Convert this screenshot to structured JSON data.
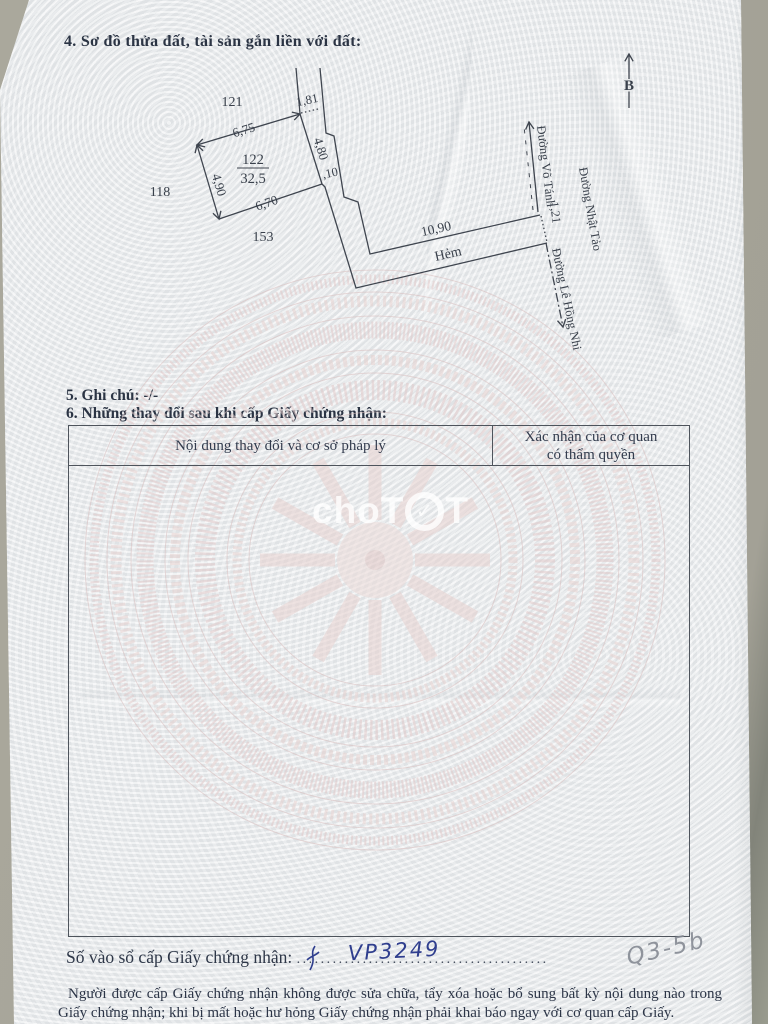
{
  "document": {
    "section4_heading": "4. Sơ đồ thửa đất, tài sản gắn liền với đất:",
    "section5_heading": "5. Ghi chú: -/-",
    "section6_heading": "6. Những thay đổi sau khi cấp Giấy chứng nhận:"
  },
  "diagram": {
    "north_label": "B",
    "parcel_number": "122",
    "parcel_area": "32,5",
    "adjacent_parcels": {
      "top": "121",
      "left": "118",
      "bottom": "153"
    },
    "dimensions": {
      "top_edge": "6,75",
      "left_edge": "4,90",
      "bottom_edge": "6,70",
      "right_edge": "4,80",
      "alley_top_width": "1,81",
      "step": ",10",
      "alley_length": "10,90",
      "street_frontage": "1,21"
    },
    "roads": {
      "alley": "Hẻm",
      "street_vo_tanh": "Đường Võ Tánh",
      "street_nhat_tao": "Đường Nhật Tảo",
      "street_le_hong_nhi": "Đường Lê Hồng Nhi"
    }
  },
  "table": {
    "col_content_header": "Nội dung thay đổi và cơ sở pháp lý",
    "col_confirm_header_line1": "Xác nhận của cơ quan",
    "col_confirm_header_line2": "có thẩm quyền"
  },
  "watermark": {
    "part1": "cho",
    "part2": "T",
    "check": "✓",
    "part3": "T"
  },
  "registry": {
    "label": "Số vào sổ cấp Giấy chứng nhận:",
    "dots": "..........................................",
    "number": "VP3249",
    "pencil_note": "Q3-5b"
  },
  "legal": {
    "text": "Người được cấp Giấy chứng nhận không được sửa chữa, tẩy xóa hoặc bổ sung bất kỳ nội dung nào trong Giấy chứng nhận; khi bị mất hoặc hư hỏng Giấy chứng nhận phải khai báo ngay với cơ quan cấp Giấy."
  },
  "colors": {
    "ink": "#2e3748",
    "diagram_line": "#3f454f",
    "handwriting_blue": "#2f3e8e",
    "pencil_grey": "#858a93",
    "drum_pink": "#e2caca"
  }
}
